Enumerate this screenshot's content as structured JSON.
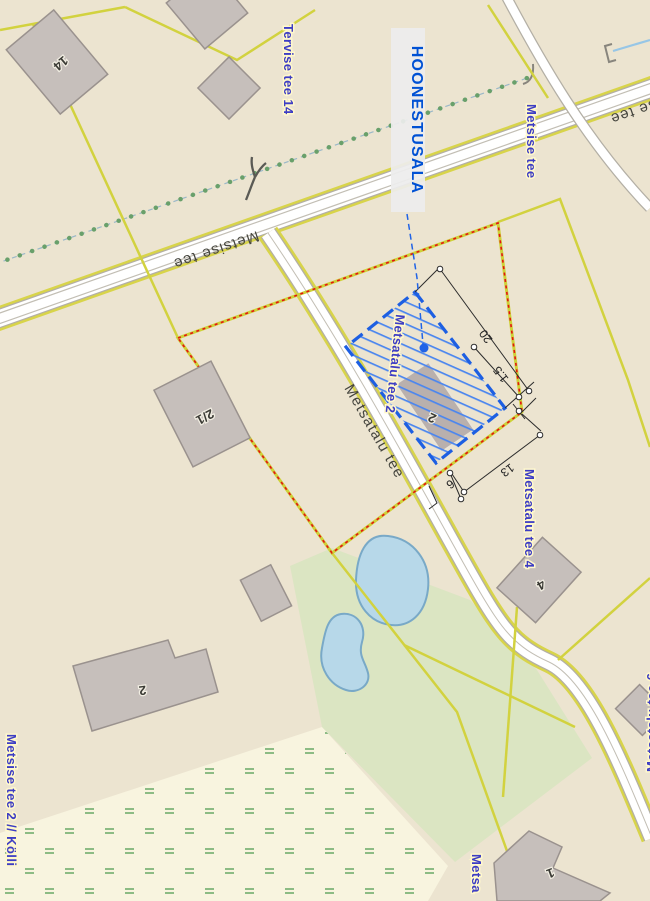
{
  "map": {
    "callout": {
      "label": "HOONESTUSALA"
    },
    "roads": {
      "metsise": "Metsise tee",
      "metsatalu": "Metsatalu tee"
    },
    "addresses": {
      "tervise14": "Tervise tee 14",
      "metsise": "Metsise tee",
      "metsatalu2": "Metsatalu tee 2",
      "metsatalu4": "Metsatalu tee 4",
      "metsatalu6": "Metsatalu tee 6",
      "metsise2": "Metsise tee 2 // Kölli",
      "metsa_partial": "Metsa"
    },
    "buildings": {
      "b14": "14",
      "b21": "2/1",
      "b2": "2",
      "b4": "4",
      "bplot": "2",
      "b1": "1"
    },
    "dimensions": {
      "d20": "20",
      "d1_5": "1.5",
      "d13": "13",
      "d6": "6"
    },
    "colors": {
      "background": "#ece4d0",
      "wetland": "#f8f4df",
      "green_area": "#dbe5c2",
      "road_fill": "#ffffff",
      "road_casing": "#b3afa5",
      "cadastral_line": "#d2d23f",
      "parcel_red": "#e51313",
      "building_fill": "#c6bfbb",
      "building_stroke": "#9a928e",
      "hoonestus_blue": "#1d5fe2",
      "address_blue": "#3d3dc4",
      "pond_fill": "#b7d8e9",
      "pond_stroke": "#79a9c7",
      "trail_green": "#69a06b",
      "water_line": "#97c6e6",
      "callout_bg": "#ededed"
    }
  }
}
